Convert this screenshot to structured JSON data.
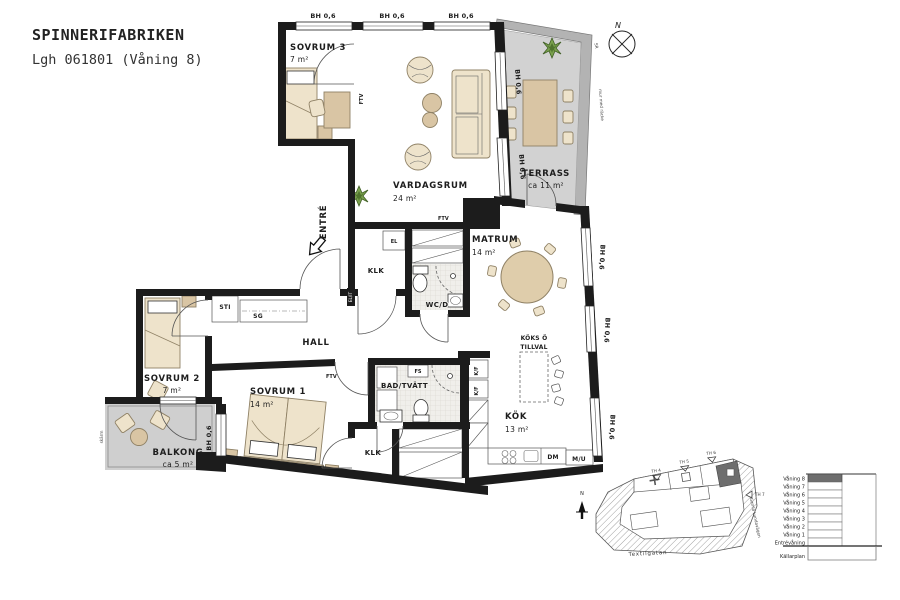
{
  "title": {
    "line1": "SPINNERIFABRIKEN",
    "line2": "Lgh 061801 (Våning 8)"
  },
  "rooms": {
    "sovrum3": {
      "name": "SOVRUM 3",
      "area": "7 m²"
    },
    "vardagsrum": {
      "name": "VARDAGSRUM",
      "area": "24 m²"
    },
    "terrass": {
      "name": "TERRASS",
      "area": "ca 11 m²"
    },
    "matrum": {
      "name": "MATRUM",
      "area": "14 m²"
    },
    "sovrum2": {
      "name": "SOVRUM 2",
      "area": "7 m²"
    },
    "sovrum1": {
      "name": "SOVRUM 1",
      "area": "14 m²"
    },
    "balkong": {
      "name": "BALKONG",
      "area": "ca 5 m²"
    },
    "kok": {
      "name": "KÖK",
      "area": "13 m²"
    },
    "hall": {
      "name": "HALL"
    },
    "klk": {
      "name": "KLK"
    },
    "wcd": {
      "name": "WC/D"
    },
    "badtvatt": {
      "name": "BAD/TVÄTT"
    }
  },
  "labels": {
    "entre": "ENTRÉ",
    "window_height": "BH 0,6",
    "ftv": "FTV",
    "el_it": "EL/IT",
    "el": "EL",
    "sti": "STI",
    "sg": "SG",
    "tt": "TT",
    "tm": "TM",
    "fs": "FS",
    "kf": "K/F",
    "dm": "DM",
    "mu": "M/U",
    "koks_o": "KÖKS Ö",
    "tillval": "TILLVAL",
    "skarm": "skärm",
    "mur": "mur med räcke",
    "sr": "SR",
    "north": "N"
  },
  "site_plan": {
    "streets": {
      "bottom": "Textilgatan",
      "right": "Gamla Lundavägen"
    },
    "markers": {
      "th4": "TH 4",
      "th5": "TH 5",
      "th6": "TH 6",
      "th7": "TH 7"
    },
    "north": "N"
  },
  "floors": {
    "levels": [
      "Våning 8",
      "Våning 7",
      "Våning 6",
      "Våning 5",
      "Våning 4",
      "Våning 3",
      "Våning 2",
      "Våning 1",
      "Entrévåning"
    ],
    "basement": "Källarplan",
    "highlighted": "Våning 8"
  },
  "colors": {
    "wall": "#1c1c1c",
    "terrace_floor": "#d2d2d2",
    "terrace_band": "#b3b3b3",
    "balcony_floor": "#cfcfcf",
    "furniture": "#eee3cb",
    "furniture_dark": "#d9c5a4",
    "plant": "#6a9440",
    "highlight": "#6e6e6e"
  }
}
